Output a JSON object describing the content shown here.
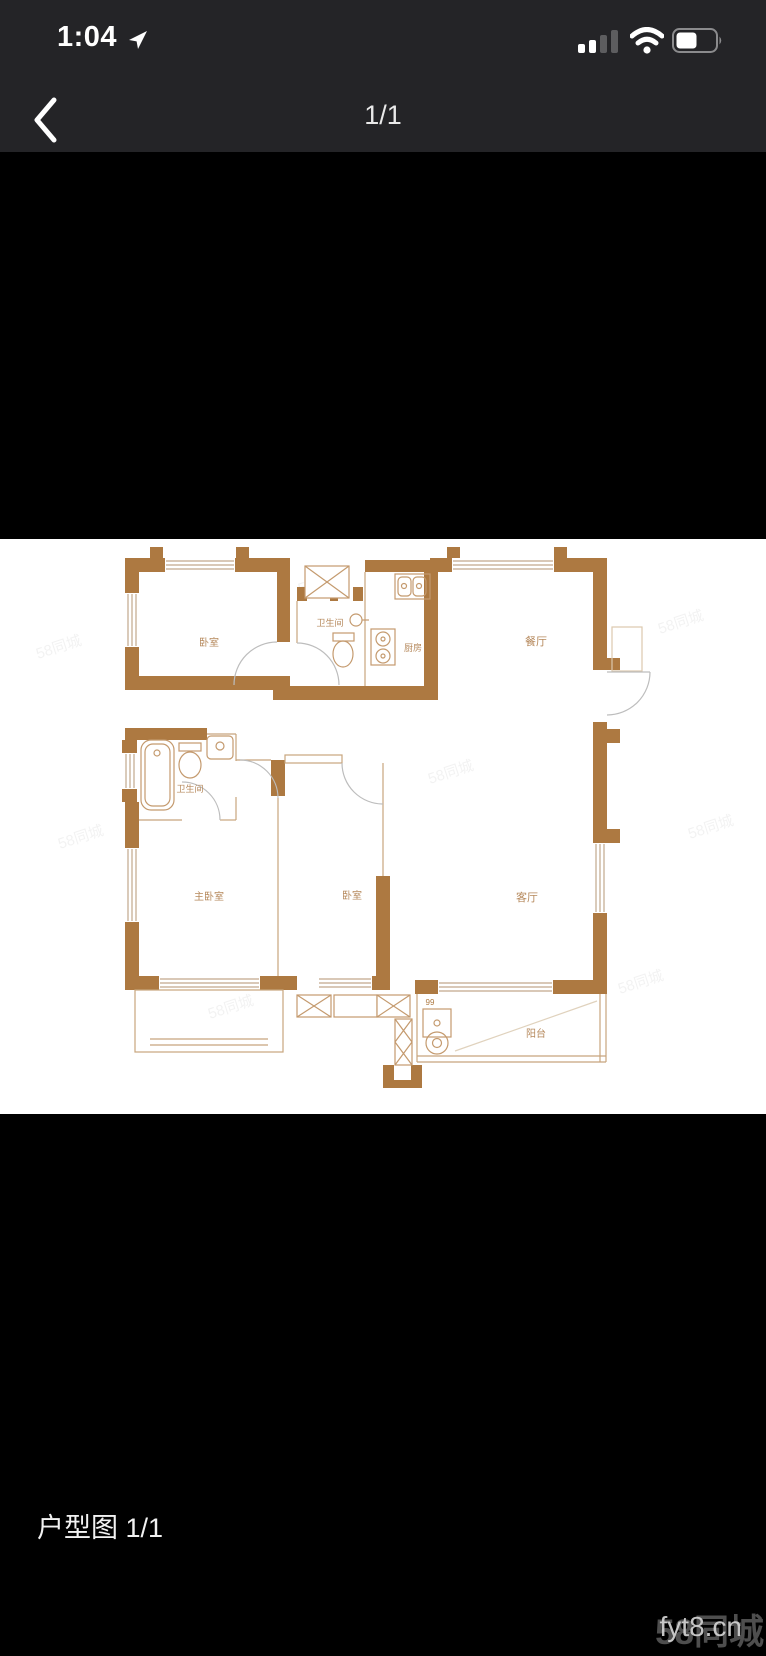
{
  "status_bar": {
    "time": "1:04",
    "cellular_bars_active": 2,
    "cellular_bars_total": 4,
    "battery_percent": 50
  },
  "nav_bar": {
    "page_indicator": "1/1"
  },
  "floorplan": {
    "rooms": [
      {
        "id": "bedroom-top-left",
        "label": "卧室"
      },
      {
        "id": "bathroom-small",
        "label": "卫生间"
      },
      {
        "id": "kitchen",
        "label": "厨房"
      },
      {
        "id": "dining-room",
        "label": "餐厅"
      },
      {
        "id": "bathroom-main",
        "label": "卫生间"
      },
      {
        "id": "master-bedroom",
        "label": "主卧室"
      },
      {
        "id": "bedroom-middle",
        "label": "卧室"
      },
      {
        "id": "living-room",
        "label": "客厅"
      },
      {
        "id": "balcony",
        "label": "阳台"
      }
    ],
    "shaft_mark": "99",
    "colors": {
      "wall": "#ad7941",
      "fixture_line": "#c49a6e",
      "window_line": "#c2a88c",
      "label": "#b6895c"
    }
  },
  "caption": {
    "label": "户型图 1/1"
  },
  "watermarks": {
    "site": "58同城",
    "code": "fyt8.cn",
    "tiled": "58同城"
  }
}
